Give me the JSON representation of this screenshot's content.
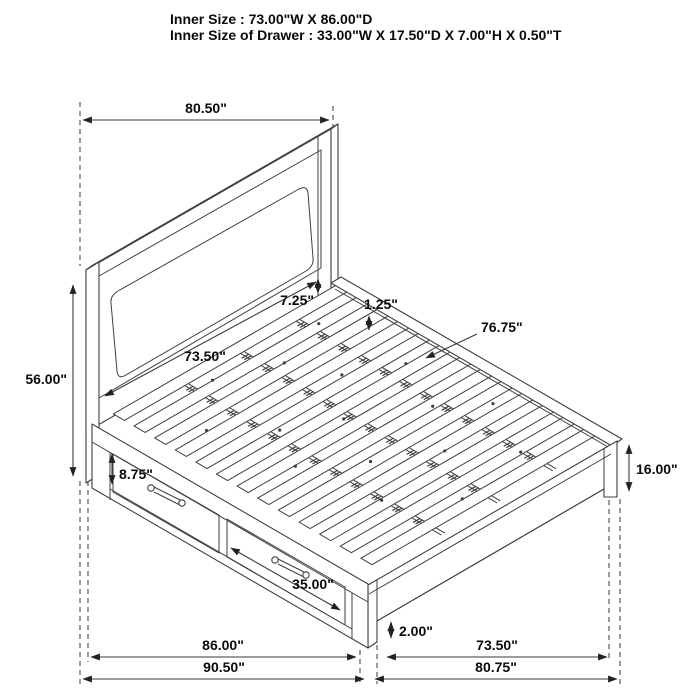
{
  "header": {
    "line1": "Inner Size : 73.00\"W X 86.00\"D",
    "line2": "Inner Size of Drawer : 33.00\"W X 17.50\"D X 7.00\"H X 0.50\"T"
  },
  "dimensions": {
    "headboard_width": "80.50\"",
    "headboard_height": "56.00\"",
    "headboard_panel_width": "73.50\"",
    "panel_to_rail": "7.25\"",
    "rail_lip_thickness": "1.25\"",
    "slat_length": "76.75\"",
    "drawer_front_height": "8.75\"",
    "drawer_front_width": "35.00\"",
    "footboard_height": "16.00\"",
    "floor_clearance": "2.00\"",
    "side_inner_length": "86.00\"",
    "side_outer_length": "90.50\"",
    "foot_inner_width": "73.50\"",
    "foot_outer_width": "80.75\""
  },
  "colors": {
    "line": "#3f3f3f",
    "dimension": "#3a3a3a",
    "text": "#0a0a0a",
    "background": "#ffffff"
  }
}
